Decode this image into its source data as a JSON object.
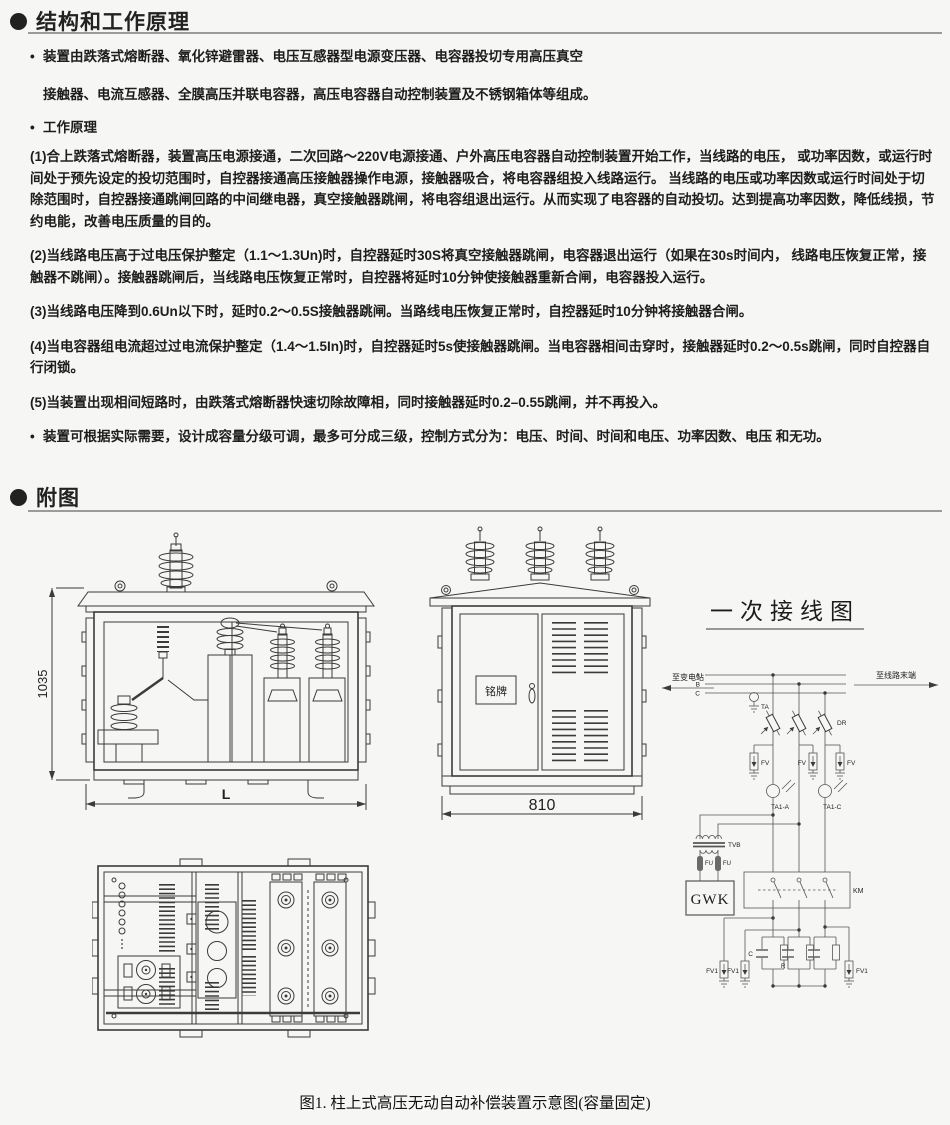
{
  "principle": {
    "marker": "•",
    "title": "结构和工作原理",
    "bullet1_line1": "装置由跌落式熔断器、氧化锌避雷器、电压互感器型电源变压器、电容器投切专用高压真空",
    "bullet1_line2": "接触器、电流互感器、全膜高压并联电容器，高压电容器自动控制装置及不锈钢箱体等组成。",
    "bullet2": "工作原理",
    "para1": "(1)合上跌落式熔断器，装置高压电源接通，二次回路～220V电源接通、户外高压电容器自动控制装置开始工作，当线路的电压， 或功率因数，或运行时间处于预先设定的投切范围时，自控器接通高压接触器操作电源，接触器吸合，将电容器组投入线路运行。 当线路的电压或功率因数或运行时间处于切除范围时，自控器接通跳闸回路的中间继电器，真空接触器跳闸，将电容组退出运行。从而实现了电容器的自动投切。达到提高功率因数，降低线损，节约电能，改善电压质量的目的。",
    "para2": "(2)当线路电压高于过电压保护整定（1.1～1.3Un)时，自控器延时30S将真空接触器跳闸，电容器退出运行（如果在30s时间内， 线路电压恢复正常，接触器不跳闸）。接触器跳闸后，当线路电压恢复正常时，自控器将延时10分钟使接触器重新合闸，电容器投入运行。",
    "para3": "(3)当线路电压降到0.6Un以下时，延时0.2～0.5S接触器跳闸。当路线电压恢复正常时，自控器延时10分钟将接触器合闸。",
    "para4": "(4)当电容器组电流超过过电流保护整定（1.4～1.5In)时，自控器延时5s使接触器跳闸。当电容器相间击穿时，接触器延时0.2～0.5s跳闸，同时自控器自行闭锁。",
    "para5": "(5)当装置出现相间短路时，由跌落式熔断器快速切除故障相，同时接触器延时0.2–0.55跳闸，并不再投入。",
    "bullet3": "装置可根据实际需要，设计成容量分级可调，最多可分成三级，控制方式分为：电压、时间、时间和电压、功率因数、电压 和无功。"
  },
  "figures": {
    "title": "附图",
    "caption": "图1. 柱上式高压无动自动补偿装置示意图(容量固定)",
    "front": {
      "height_dim": "1035",
      "width_dim": "L"
    },
    "side": {
      "nameplate": "铭牌",
      "width_dim": "810"
    },
    "wiring": {
      "title": "一次接线图",
      "to_substation": "至变电站",
      "to_line_end": "至线路末端",
      "phase_a": "A",
      "phase_b": "B",
      "phase_c": "C",
      "ta": "TA",
      "dr": "DR",
      "fv": "FV",
      "ta1_a": "TA1-A",
      "ta1_c": "TA1-C",
      "tvb": "TVB",
      "fu": "FU",
      "gwk": "GWK",
      "km": "KM",
      "fv1": "FV1",
      "cap_c": "C",
      "cap_r": "R"
    }
  }
}
